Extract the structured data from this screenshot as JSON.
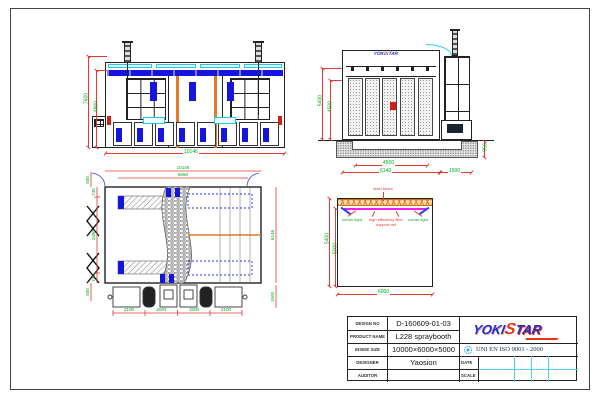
{
  "colors": {
    "dim_line": "#e23b30",
    "dim_text": "#00a818",
    "booth_blue": "#1515dd",
    "column_orange": "#e07b28",
    "strip_cyan": "#19c9e6",
    "filter_magenta": "#f21df2",
    "logo_blue": "#1b2fd0",
    "logo_red": "#e8350f"
  },
  "front_view": {
    "dim_width": "10146",
    "dim_height_outer": "7600",
    "dim_height_inner": "4900"
  },
  "side_view": {
    "dim_height_outer": "5400",
    "dim_height_inner": "4500",
    "dim_width_inner": "4500",
    "dim_width_outer": "6146",
    "dim_machine_width": "1500",
    "dim_pit_depth": "950"
  },
  "plan_view": {
    "dim_width_outer": "10146",
    "dim_width_inner": "6650",
    "dim_left_top": "500",
    "dim_left_upper": "745",
    "dim_left_middle": "3480",
    "dim_left_lower": "745",
    "dim_left_bottom": "500",
    "dim_depth": "6146",
    "dim_bottom": [
      "2100",
      "1500",
      "1500",
      "2100"
    ],
    "dim_machine_depth": "1500"
  },
  "section_view": {
    "label_beam": "steel beam",
    "label_corner_light_left": "corner light",
    "label_filter": "high efficiency filter support net",
    "label_corner_light_right": "corner light",
    "dim_height_outer": "5400",
    "dim_height_inner": "5000",
    "dim_width": "6000"
  },
  "title_block": {
    "rows": [
      {
        "label": "DESIGN NO",
        "value": "D-160609-01-03"
      },
      {
        "label": "PRODUCT NAME",
        "value": "L228 spraybooth"
      },
      {
        "label": "INSIDE SIZE",
        "value": "10000×6000×5000"
      },
      {
        "label": "DESIGNER",
        "value": "Yaosion"
      },
      {
        "label": "AUDITOR",
        "value": ""
      }
    ],
    "logo_text_1": "YOKI",
    "logo_text_2": "S",
    "logo_text_3": "TAR",
    "cert_text": "UNI EN ISO 9001 - 2000",
    "date_label": "DATE",
    "scale_label": "SCALE"
  }
}
